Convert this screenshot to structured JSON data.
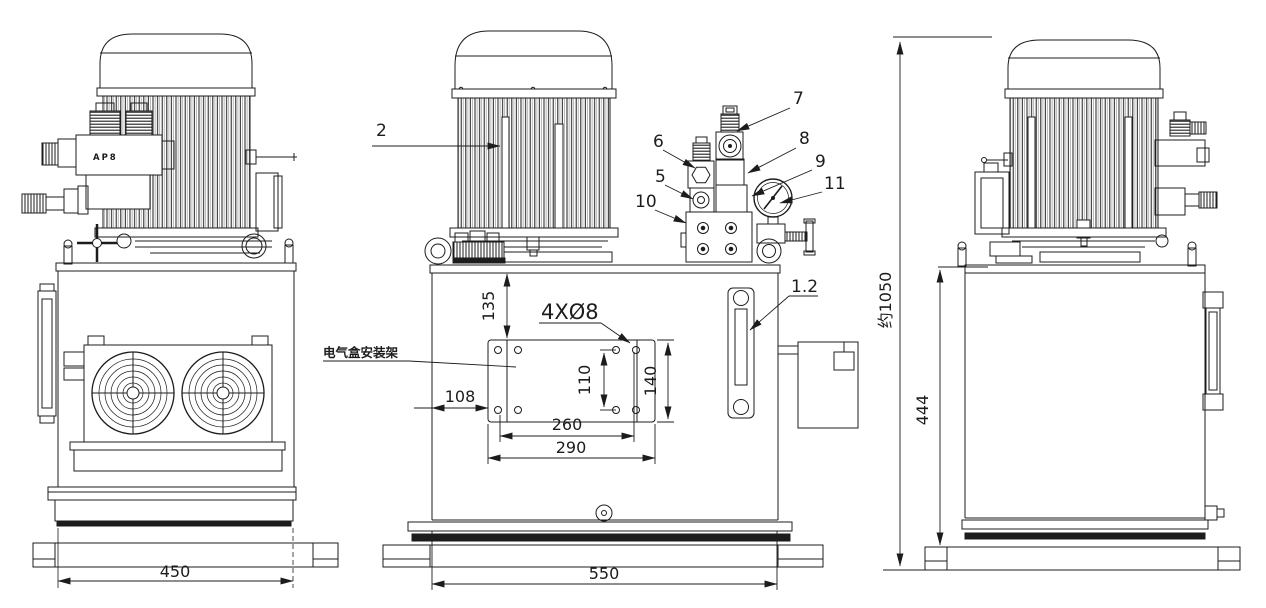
{
  "labels": {
    "motor": "2",
    "item5": "5",
    "item6": "6",
    "item7": "7",
    "item8": "8",
    "item9": "9",
    "item10": "10",
    "item11": "11",
    "level_gauge": "1.2",
    "valve_marking": "AP8",
    "bracket_note": "电气盒安装架",
    "hole_callout": "4XØ8"
  },
  "dimensions": {
    "bracket_top_offset": "135",
    "hole_vertical_spacing": "110",
    "bracket_height": "140",
    "bracket_left_offset": "108",
    "hole_horizontal_spacing": "260",
    "bracket_width": "290",
    "base_width_side": "450",
    "base_width_front": "550",
    "overall_height": "约1050",
    "tank_height": "444"
  },
  "colors": {
    "line": "#1c1c1c",
    "background": "#ffffff"
  }
}
